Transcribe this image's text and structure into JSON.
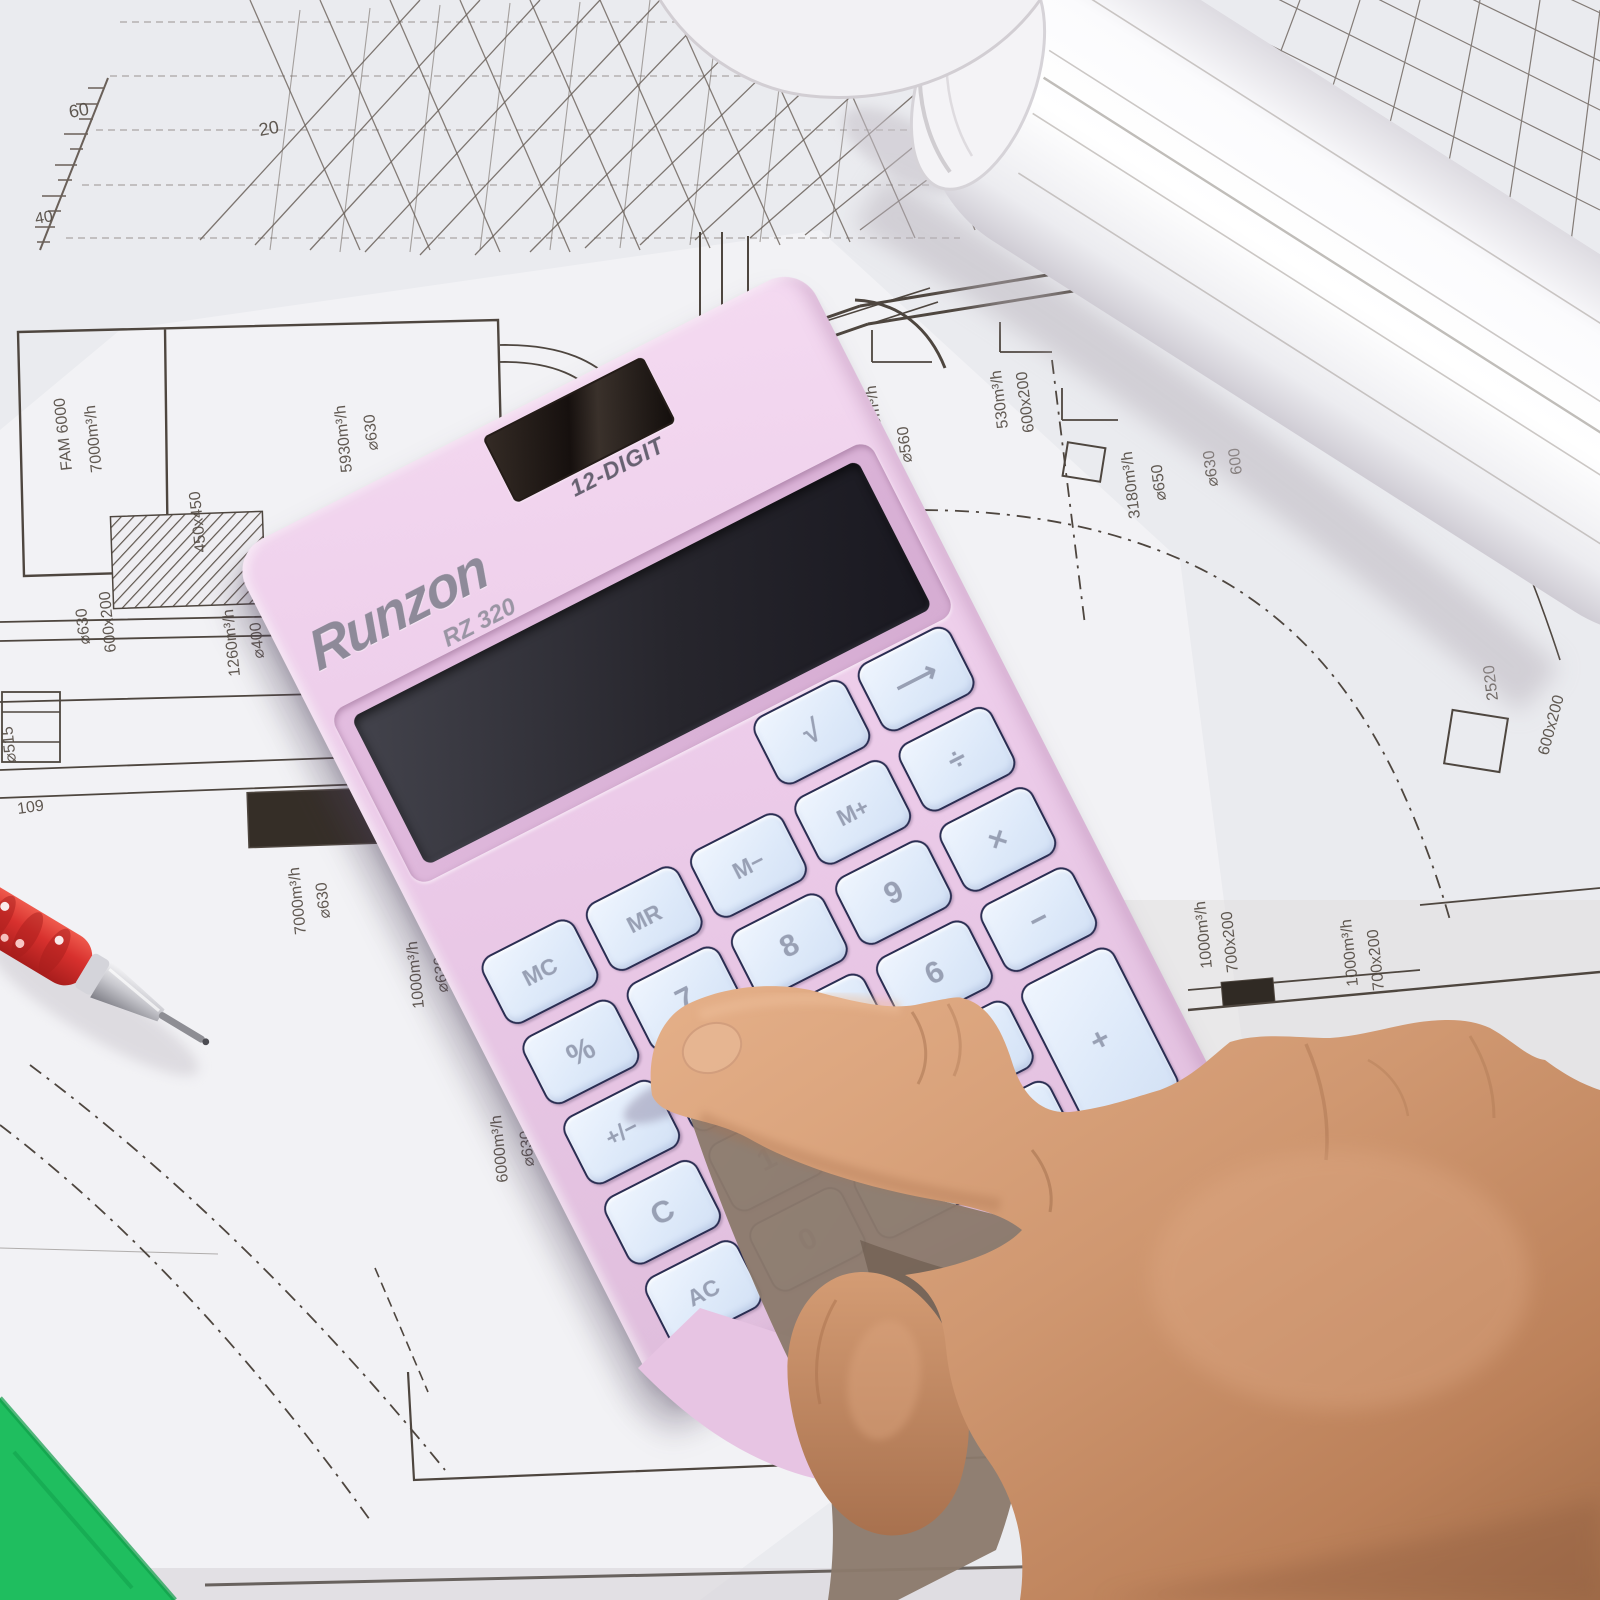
{
  "scene": {
    "description": "Pink Runzon RZ 320 12-digit solar calculator lying on architectural HVAC blueprints; a hand presses a key; red mechanical pencil at left; rolled drawing at top right; green set square at bottom left"
  },
  "calculator": {
    "brand": "Runzon",
    "model": "RZ 320",
    "display_label": "12-DIGIT",
    "body_color": "#ecccE9",
    "key_color": "#dde9f9",
    "key_outline_color": "#2a2d52",
    "key_text_color": "#98a0b4",
    "display_color": "#26252c",
    "solar_color": "#16100e",
    "keys": [
      {
        "label": "√",
        "name": "sqrt",
        "col": 3,
        "row": 0
      },
      {
        "label": "⟶",
        "name": "backspace-arrow",
        "col": 4,
        "row": 0
      },
      {
        "label": "MC",
        "name": "memory-clear",
        "col": 0,
        "row": 1
      },
      {
        "label": "MR",
        "name": "memory-recall",
        "col": 1,
        "row": 1
      },
      {
        "label": "M−",
        "name": "memory-minus",
        "col": 2,
        "row": 1
      },
      {
        "label": "M+",
        "name": "memory-plus",
        "col": 3,
        "row": 1
      },
      {
        "label": "÷",
        "name": "divide",
        "col": 4,
        "row": 1
      },
      {
        "label": "%",
        "name": "percent",
        "col": 0,
        "row": 2
      },
      {
        "label": "7",
        "name": "digit-7",
        "col": 1,
        "row": 2
      },
      {
        "label": "8",
        "name": "digit-8",
        "col": 2,
        "row": 2
      },
      {
        "label": "9",
        "name": "digit-9",
        "col": 3,
        "row": 2
      },
      {
        "label": "×",
        "name": "multiply",
        "col": 4,
        "row": 2
      },
      {
        "label": "+/−",
        "name": "plus-minus",
        "col": 0,
        "row": 3
      },
      {
        "label": "4",
        "name": "digit-4",
        "col": 1,
        "row": 3
      },
      {
        "label": "5",
        "name": "digit-5",
        "col": 2,
        "row": 3
      },
      {
        "label": "6",
        "name": "digit-6",
        "col": 3,
        "row": 3
      },
      {
        "label": "−",
        "name": "minus",
        "col": 4,
        "row": 3
      },
      {
        "label": "C",
        "name": "clear",
        "col": 0,
        "row": 4
      },
      {
        "label": "1",
        "name": "digit-1",
        "col": 1,
        "row": 4
      },
      {
        "label": "2",
        "name": "digit-2",
        "col": 2,
        "row": 4
      },
      {
        "label": "3",
        "name": "digit-3",
        "col": 3,
        "row": 4
      },
      {
        "label": "+",
        "name": "plus",
        "col": 4,
        "row": 4,
        "tall": true
      },
      {
        "label": "AC",
        "name": "all-clear",
        "col": 0,
        "row": 5
      },
      {
        "label": "0",
        "name": "digit-0",
        "col": 1,
        "row": 5
      },
      {
        "label": ".",
        "name": "decimal",
        "col": 2,
        "row": 5
      },
      {
        "label": "=",
        "name": "equals",
        "col": 3,
        "row": 5
      }
    ]
  },
  "blueprint": {
    "line_color": "#5a524a",
    "labels": [
      {
        "text": "60"
      },
      {
        "text": "20"
      },
      {
        "text": "40"
      },
      {
        "text": "FAM 6000"
      },
      {
        "text": "7000m³/h"
      },
      {
        "text": "5930m³/h"
      },
      {
        "text": "⌀630"
      },
      {
        "text": "450x450"
      },
      {
        "text": "⌀630"
      },
      {
        "text": "600x200"
      },
      {
        "text": "1260m³/h"
      },
      {
        "text": "⌀400"
      },
      {
        "text": "⌀515"
      },
      {
        "text": "109"
      },
      {
        "text": "7000m³/h"
      },
      {
        "text": "⌀630"
      },
      {
        "text": "1000m³/h"
      },
      {
        "text": "⌀630"
      },
      {
        "text": "6000m³/h"
      },
      {
        "text": "⌀630"
      },
      {
        "text": "4410m³/h"
      },
      {
        "text": "⌀560"
      },
      {
        "text": "530m³/h"
      },
      {
        "text": "600x200"
      },
      {
        "text": "3180m³/h"
      },
      {
        "text": "⌀650"
      },
      {
        "text": "⌀630"
      },
      {
        "text": "600"
      },
      {
        "text": "2520"
      },
      {
        "text": "600x200"
      },
      {
        "text": "1000m³/h"
      },
      {
        "text": "700x200"
      },
      {
        "text": "1000m³/h"
      },
      {
        "text": "700x200"
      }
    ]
  },
  "objects": {
    "pencil": {
      "type": "red mechanical pencil",
      "grip_color": "#d8312e"
    },
    "set_square": {
      "color": "#1fbe5f"
    },
    "rolled_drawing": {
      "color": "#f7f7fa"
    },
    "hand": {
      "skin_color": "#d09871",
      "action": "index finger pressing a key"
    }
  }
}
